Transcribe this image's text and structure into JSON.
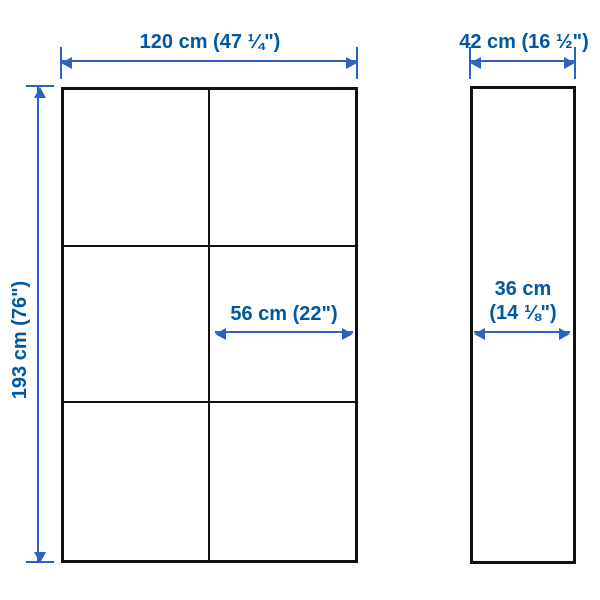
{
  "diagram": {
    "type": "furniture-dimension-diagram",
    "views": {
      "front": {
        "columns": 2,
        "rows": 3
      },
      "side": {}
    },
    "dimensions": {
      "overall_width": "120 cm (47 ¼\")",
      "overall_depth": "42 cm (16 ½\")",
      "overall_height": "193 cm (76\")",
      "inner_width": "56 cm (22\")",
      "inner_depth_line1": "36 cm",
      "inner_depth_line2": "(14 ⅛\")"
    },
    "colors": {
      "dimension_text": "#0058a3",
      "dimension_line": "#2e62c0",
      "outline": "#111111",
      "background": "#ffffff"
    }
  }
}
